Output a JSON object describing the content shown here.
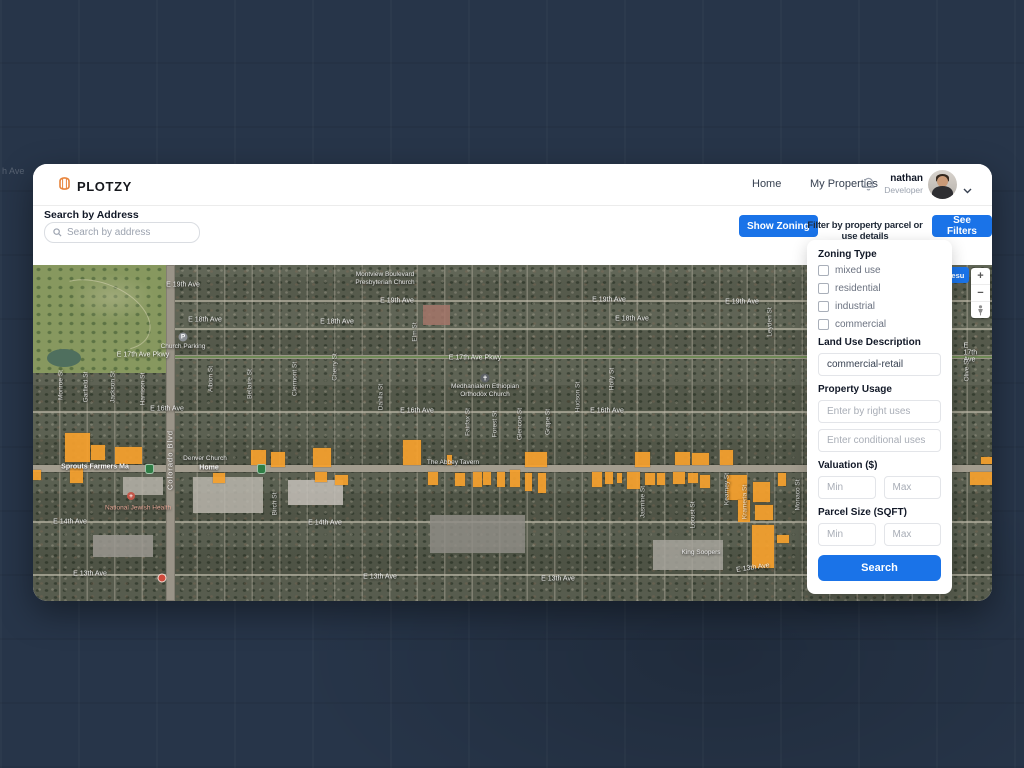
{
  "brand": {
    "name": "PLOTZY"
  },
  "nav": {
    "home": "Home",
    "my_properties": "My Properties",
    "user_name": "nathan",
    "user_role": "Developer"
  },
  "search": {
    "label": "Search by Address",
    "placeholder": "Search by address"
  },
  "toolbar": {
    "show_zoning": "Show Zoning",
    "caption": "Filter by property parcel or use details",
    "see_filters": "See Filters"
  },
  "filters": {
    "zoning_type_label": "Zoning Type",
    "zoning_options": [
      "mixed use",
      "residential",
      "industrial",
      "commercial"
    ],
    "land_use_label": "Land Use Description",
    "land_use_value": "commercial-retail",
    "property_usage_label": "Property Usage",
    "by_right_placeholder": "Enter by right uses",
    "conditional_placeholder": "Enter conditional uses",
    "valuation_label": "Valuation ($)",
    "min_placeholder": "Min",
    "max_placeholder": "Max",
    "parcel_size_label": "Parcel Size (SQFT)",
    "search_button": "Search"
  },
  "map": {
    "results_button_visible_text": "Resu",
    "zoom_in": "+",
    "zoom_out": "−",
    "colors": {
      "accent_blue": "#1A73E8",
      "parcel_orange": "#F6A12E"
    },
    "ghost_label": "h Ave",
    "labels": [
      {
        "t": "E 19th Ave",
        "x": 150,
        "y": 20,
        "k": "h"
      },
      {
        "t": "E 19th Ave",
        "x": 364,
        "y": 36,
        "k": "h"
      },
      {
        "t": "E 19th Ave",
        "x": 576,
        "y": 35,
        "k": "h"
      },
      {
        "t": "E 19th Ave",
        "x": 709,
        "y": 37,
        "k": "h"
      },
      {
        "t": "E 18th Ave",
        "x": 172,
        "y": 55,
        "k": "h"
      },
      {
        "t": "E 18th Ave",
        "x": 304,
        "y": 57,
        "k": "h"
      },
      {
        "t": "E 18th Ave",
        "x": 599,
        "y": 54,
        "k": "h"
      },
      {
        "t": "E 17th Ave Pkwy",
        "x": 110,
        "y": 90,
        "k": "h"
      },
      {
        "t": "E 17th Ave Pkwy",
        "x": 442,
        "y": 93,
        "k": "h"
      },
      {
        "t": "E 17th Ave",
        "x": 940,
        "y": 88,
        "k": "h"
      },
      {
        "t": "E 16th Ave",
        "x": 134,
        "y": 144,
        "k": "h"
      },
      {
        "t": "E 16th Ave",
        "x": 384,
        "y": 146,
        "k": "h"
      },
      {
        "t": "E 16th Ave",
        "x": 574,
        "y": 146,
        "k": "h"
      },
      {
        "t": "E 14th Ave",
        "x": 37,
        "y": 257,
        "k": "h"
      },
      {
        "t": "E 14th Ave",
        "x": 292,
        "y": 258,
        "k": "h"
      },
      {
        "t": "E 13th Ave",
        "x": 57,
        "y": 309,
        "k": "h"
      },
      {
        "t": "E 13th Ave",
        "x": 347,
        "y": 312,
        "k": "h"
      },
      {
        "t": "E 13th Ave",
        "x": 525,
        "y": 314,
        "k": "h"
      },
      {
        "t": "E 13th Ave",
        "x": 720,
        "y": 303,
        "k": "h",
        "r": -8
      },
      {
        "t": "Monroe St",
        "x": 28,
        "y": 120,
        "k": "v"
      },
      {
        "t": "Garfield St",
        "x": 53,
        "y": 122,
        "k": "v"
      },
      {
        "t": "Jackson St",
        "x": 80,
        "y": 122,
        "k": "v"
      },
      {
        "t": "Harrison St",
        "x": 110,
        "y": 124,
        "k": "v"
      },
      {
        "t": "Albion St",
        "x": 178,
        "y": 114,
        "k": "v"
      },
      {
        "t": "Bellaire St",
        "x": 217,
        "y": 119,
        "k": "v"
      },
      {
        "t": "Birch St",
        "x": 242,
        "y": 239,
        "k": "v"
      },
      {
        "t": "Clermont St",
        "x": 262,
        "y": 114,
        "k": "v"
      },
      {
        "t": "Cherry St",
        "x": 302,
        "y": 102,
        "k": "v"
      },
      {
        "t": "Dahlia St",
        "x": 348,
        "y": 132,
        "k": "v"
      },
      {
        "t": "Elm St",
        "x": 382,
        "y": 67,
        "k": "v"
      },
      {
        "t": "Fairfax St",
        "x": 435,
        "y": 157,
        "k": "v"
      },
      {
        "t": "Forest St",
        "x": 462,
        "y": 159,
        "k": "v"
      },
      {
        "t": "Glencoe St",
        "x": 487,
        "y": 159,
        "k": "v"
      },
      {
        "t": "Grape St",
        "x": 515,
        "y": 157,
        "k": "v"
      },
      {
        "t": "Hudson St",
        "x": 545,
        "y": 132,
        "k": "v"
      },
      {
        "t": "Holly St",
        "x": 579,
        "y": 114,
        "k": "v"
      },
      {
        "t": "Jasmine St",
        "x": 610,
        "y": 237,
        "k": "v"
      },
      {
        "t": "Locust St",
        "x": 660,
        "y": 250,
        "k": "v"
      },
      {
        "t": "Kearney St",
        "x": 694,
        "y": 224,
        "k": "v"
      },
      {
        "t": "Krameria St",
        "x": 712,
        "y": 237,
        "k": "v"
      },
      {
        "t": "Leyden St",
        "x": 737,
        "y": 57,
        "k": "v"
      },
      {
        "t": "Monaco St",
        "x": 765,
        "y": 230,
        "k": "v"
      },
      {
        "t": "Olive St",
        "x": 934,
        "y": 105,
        "k": "v"
      },
      {
        "t": "Colorado Blvd",
        "x": 137,
        "y": 195,
        "k": "vbig"
      },
      {
        "t": "Montview Boulevard\nPresbyterian Church",
        "x": 352,
        "y": 14,
        "k": "poi"
      },
      {
        "t": "Church Parking",
        "x": 150,
        "y": 82,
        "k": "poi"
      },
      {
        "t": "Medhanialem Ethiopian\nOrthodox Church",
        "x": 452,
        "y": 126,
        "k": "poi"
      },
      {
        "t": "Sprouts Farmers Ma",
        "x": 62,
        "y": 202,
        "k": "poib"
      },
      {
        "t": "Home",
        "x": 176,
        "y": 203,
        "k": "poib"
      },
      {
        "t": "Denver Church",
        "x": 172,
        "y": 194,
        "k": "poi"
      },
      {
        "t": "The Abbey Tavern",
        "x": 420,
        "y": 198,
        "k": "poi"
      },
      {
        "t": "King Soopers",
        "x": 668,
        "y": 288,
        "k": "poi"
      },
      {
        "t": "National Jewish Health",
        "x": 105,
        "y": 243,
        "k": "red"
      }
    ],
    "shields": [
      {
        "x": 112,
        "y": 199
      },
      {
        "x": 224,
        "y": 199
      }
    ],
    "parcels": [
      [
        32,
        168,
        25,
        29
      ],
      [
        58,
        180,
        14,
        15
      ],
      [
        82,
        182,
        27,
        17
      ],
      [
        37,
        203,
        13,
        15
      ],
      [
        0,
        205,
        8,
        10
      ],
      [
        180,
        208,
        12,
        10
      ],
      [
        218,
        185,
        15,
        15
      ],
      [
        238,
        187,
        14,
        15
      ],
      [
        280,
        183,
        18,
        19
      ],
      [
        302,
        210,
        13,
        10
      ],
      [
        282,
        207,
        12,
        10
      ],
      [
        370,
        175,
        18,
        25
      ],
      [
        395,
        207,
        10,
        13
      ],
      [
        414,
        190,
        5,
        10
      ],
      [
        422,
        208,
        10,
        13
      ],
      [
        440,
        207,
        9,
        15
      ],
      [
        450,
        207,
        8,
        13
      ],
      [
        464,
        207,
        8,
        15
      ],
      [
        477,
        205,
        10,
        17
      ],
      [
        492,
        187,
        22,
        15
      ],
      [
        492,
        208,
        7,
        18
      ],
      [
        505,
        208,
        8,
        20
      ],
      [
        559,
        207,
        10,
        15
      ],
      [
        572,
        207,
        8,
        12
      ],
      [
        584,
        208,
        5,
        10
      ],
      [
        594,
        207,
        13,
        17
      ],
      [
        602,
        187,
        15,
        15
      ],
      [
        612,
        208,
        10,
        12
      ],
      [
        624,
        208,
        8,
        12
      ],
      [
        642,
        187,
        15,
        13
      ],
      [
        659,
        188,
        17,
        12
      ],
      [
        687,
        185,
        13,
        15
      ],
      [
        640,
        207,
        12,
        12
      ],
      [
        655,
        208,
        10,
        10
      ],
      [
        667,
        210,
        10,
        13
      ],
      [
        694,
        210,
        20,
        25
      ],
      [
        705,
        235,
        12,
        22
      ],
      [
        720,
        217,
        17,
        20
      ],
      [
        722,
        240,
        18,
        15
      ],
      [
        745,
        208,
        8,
        13
      ],
      [
        719,
        260,
        22,
        43
      ],
      [
        744,
        270,
        12,
        8
      ],
      [
        948,
        192,
        12,
        7
      ],
      [
        937,
        207,
        23,
        13
      ]
    ]
  }
}
